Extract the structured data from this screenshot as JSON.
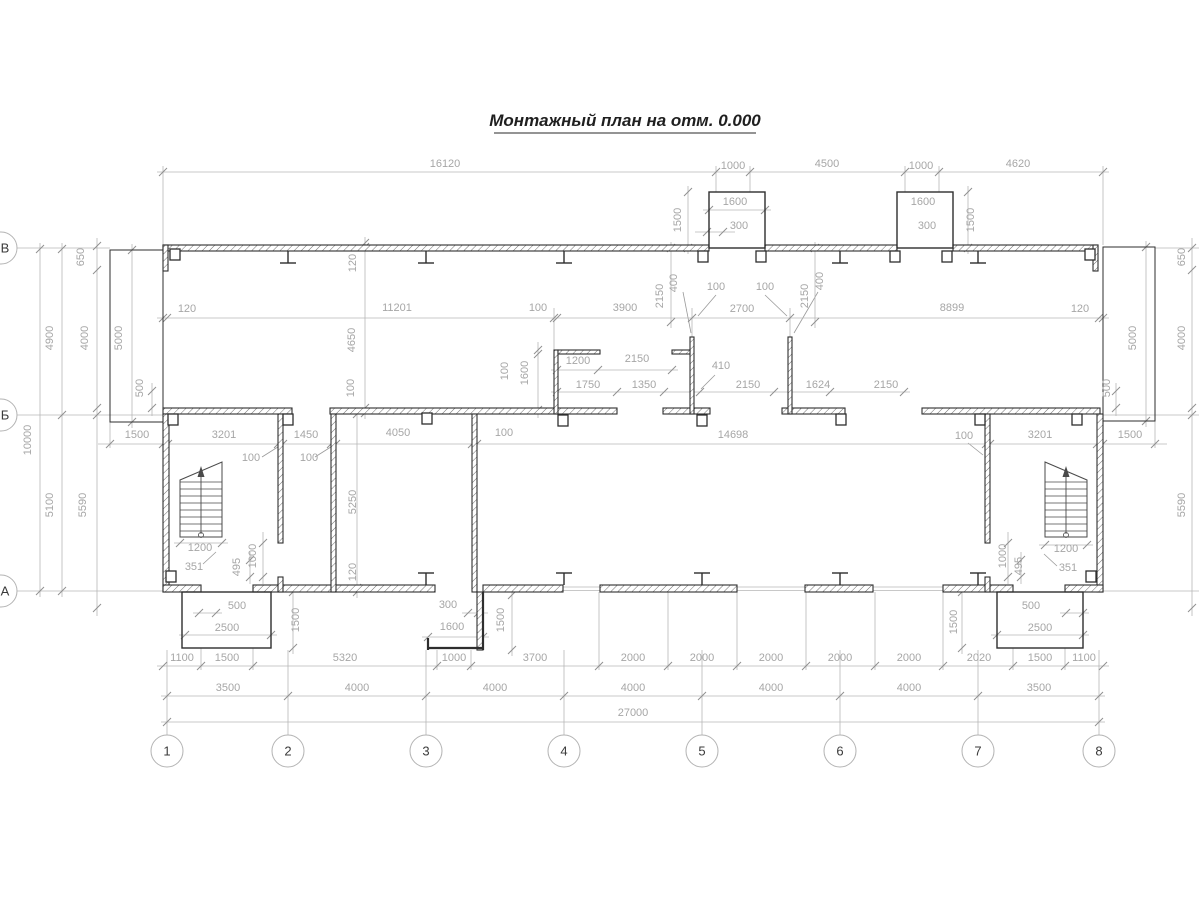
{
  "title": {
    "text": "Монтажный план на отм. 0.000"
  },
  "colors": {
    "wall_line": "#2e2e2e",
    "hatch": "#6f6f6f",
    "dim_line": "#b6b6b6",
    "dim_text": "#a6a6a6",
    "bubble_stroke": "#b3b3b3",
    "bubble_text": "#3a3a3a",
    "stair_line": "#4a4a4a"
  },
  "axes": {
    "columns": [
      {
        "label": "1",
        "x": 167
      },
      {
        "label": "2",
        "x": 288
      },
      {
        "label": "3",
        "x": 426
      },
      {
        "label": "4",
        "x": 564
      },
      {
        "label": "5",
        "x": 702
      },
      {
        "label": "6",
        "x": 840
      },
      {
        "label": "7",
        "x": 978
      },
      {
        "label": "8",
        "x": 1099
      }
    ],
    "columns_y": 751,
    "rows": [
      {
        "label": "В",
        "y": 248
      },
      {
        "label": "Б",
        "y": 415
      },
      {
        "label": "А",
        "y": 591
      }
    ],
    "rows_x": 0
  },
  "dim_labels": [
    {
      "t": "16120",
      "x": 445,
      "y": 167,
      "r": 0
    },
    {
      "t": "1000",
      "x": 733,
      "y": 169,
      "r": 0
    },
    {
      "t": "4500",
      "x": 827,
      "y": 167,
      "r": 0
    },
    {
      "t": "1000",
      "x": 921,
      "y": 169,
      "r": 0
    },
    {
      "t": "4620",
      "x": 1018,
      "y": 167,
      "r": 0
    },
    {
      "t": "1600",
      "x": 735,
      "y": 205,
      "r": 0
    },
    {
      "t": "300",
      "x": 739,
      "y": 229,
      "r": 0
    },
    {
      "t": "1500",
      "x": 681,
      "y": 220,
      "r": -90
    },
    {
      "t": "1600",
      "x": 923,
      "y": 205,
      "r": 0
    },
    {
      "t": "300",
      "x": 927,
      "y": 229,
      "r": 0
    },
    {
      "t": "1500",
      "x": 974,
      "y": 220,
      "r": -90
    },
    {
      "t": "120",
      "x": 187,
      "y": 312,
      "r": 0
    },
    {
      "t": "11201",
      "x": 397,
      "y": 311,
      "r": 0
    },
    {
      "t": "100",
      "x": 538,
      "y": 311,
      "r": 0
    },
    {
      "t": "3900",
      "x": 625,
      "y": 311,
      "r": 0
    },
    {
      "t": "100",
      "x": 716,
      "y": 290,
      "r": 0
    },
    {
      "t": "100",
      "x": 765,
      "y": 290,
      "r": 0
    },
    {
      "t": "2700",
      "x": 742,
      "y": 312,
      "r": 0
    },
    {
      "t": "8899",
      "x": 952,
      "y": 311,
      "r": 0
    },
    {
      "t": "120",
      "x": 1080,
      "y": 312,
      "r": 0
    },
    {
      "t": "2150",
      "x": 663,
      "y": 296,
      "r": -90
    },
    {
      "t": "400",
      "x": 677,
      "y": 283,
      "r": -90
    },
    {
      "t": "2150",
      "x": 808,
      "y": 296,
      "r": -90
    },
    {
      "t": "400",
      "x": 823,
      "y": 281,
      "r": -90
    },
    {
      "t": "650",
      "x": 84,
      "y": 257,
      "r": -90
    },
    {
      "t": "4900",
      "x": 53,
      "y": 338,
      "r": -90
    },
    {
      "t": "4000",
      "x": 88,
      "y": 338,
      "r": -90
    },
    {
      "t": "5000",
      "x": 122,
      "y": 338,
      "r": -90
    },
    {
      "t": "10000",
      "x": 31,
      "y": 440,
      "r": -90
    },
    {
      "t": "5100",
      "x": 53,
      "y": 505,
      "r": -90
    },
    {
      "t": "5590",
      "x": 86,
      "y": 505,
      "r": -90
    },
    {
      "t": "500",
      "x": 143,
      "y": 388,
      "r": -90
    },
    {
      "t": "1500",
      "x": 137,
      "y": 438,
      "r": 0
    },
    {
      "t": "650",
      "x": 1185,
      "y": 257,
      "r": -90
    },
    {
      "t": "4000",
      "x": 1185,
      "y": 338,
      "r": -90
    },
    {
      "t": "5000",
      "x": 1136,
      "y": 338,
      "r": -90
    },
    {
      "t": "500",
      "x": 1110,
      "y": 388,
      "r": -90
    },
    {
      "t": "5590",
      "x": 1185,
      "y": 505,
      "r": -90
    },
    {
      "t": "1500",
      "x": 1130,
      "y": 438,
      "r": 0
    },
    {
      "t": "120",
      "x": 356,
      "y": 263,
      "r": -90
    },
    {
      "t": "4650",
      "x": 355,
      "y": 340,
      "r": -90
    },
    {
      "t": "100",
      "x": 354,
      "y": 388,
      "r": -90
    },
    {
      "t": "5250",
      "x": 356,
      "y": 502,
      "r": -90
    },
    {
      "t": "120",
      "x": 356,
      "y": 572,
      "r": -90
    },
    {
      "t": "100",
      "x": 508,
      "y": 371,
      "r": -90
    },
    {
      "t": "1600",
      "x": 528,
      "y": 373,
      "r": -90
    },
    {
      "t": "1200",
      "x": 578,
      "y": 364,
      "r": 0
    },
    {
      "t": "2150",
      "x": 637,
      "y": 362,
      "r": 0
    },
    {
      "t": "410",
      "x": 721,
      "y": 369,
      "r": 0
    },
    {
      "t": "1750",
      "x": 588,
      "y": 388,
      "r": 0
    },
    {
      "t": "1350",
      "x": 644,
      "y": 388,
      "r": 0
    },
    {
      "t": "2150",
      "x": 748,
      "y": 388,
      "r": 0
    },
    {
      "t": "1624",
      "x": 818,
      "y": 388,
      "r": 0
    },
    {
      "t": "2150",
      "x": 886,
      "y": 388,
      "r": 0
    },
    {
      "t": "3201",
      "x": 224,
      "y": 438,
      "r": 0
    },
    {
      "t": "1450",
      "x": 306,
      "y": 438,
      "r": 0
    },
    {
      "t": "100",
      "x": 251,
      "y": 461,
      "r": 0
    },
    {
      "t": "100",
      "x": 309,
      "y": 461,
      "r": 0
    },
    {
      "t": "4050",
      "x": 398,
      "y": 436,
      "r": 0
    },
    {
      "t": "100",
      "x": 504,
      "y": 436,
      "r": 0
    },
    {
      "t": "14698",
      "x": 733,
      "y": 438,
      "r": 0
    },
    {
      "t": "100",
      "x": 964,
      "y": 439,
      "r": 0
    },
    {
      "t": "3201",
      "x": 1040,
      "y": 438,
      "r": 0
    },
    {
      "t": "1200",
      "x": 200,
      "y": 551,
      "r": 0
    },
    {
      "t": "351",
      "x": 194,
      "y": 570,
      "r": 0
    },
    {
      "t": "495",
      "x": 240,
      "y": 567,
      "r": -90
    },
    {
      "t": "1000",
      "x": 256,
      "y": 556,
      "r": -90
    },
    {
      "t": "1200",
      "x": 1066,
      "y": 552,
      "r": 0
    },
    {
      "t": "351",
      "x": 1068,
      "y": 571,
      "r": 0
    },
    {
      "t": "495",
      "x": 1022,
      "y": 566,
      "r": -90
    },
    {
      "t": "1000",
      "x": 1006,
      "y": 556,
      "r": -90
    },
    {
      "t": "500",
      "x": 237,
      "y": 609,
      "r": 0
    },
    {
      "t": "2500",
      "x": 227,
      "y": 631,
      "r": 0
    },
    {
      "t": "1500",
      "x": 299,
      "y": 620,
      "r": -90
    },
    {
      "t": "300",
      "x": 448,
      "y": 608,
      "r": 0
    },
    {
      "t": "1600",
      "x": 452,
      "y": 630,
      "r": 0
    },
    {
      "t": "1500",
      "x": 504,
      "y": 620,
      "r": -90
    },
    {
      "t": "500",
      "x": 1031,
      "y": 609,
      "r": 0
    },
    {
      "t": "2500",
      "x": 1040,
      "y": 631,
      "r": 0
    },
    {
      "t": "1500",
      "x": 957,
      "y": 622,
      "r": -90
    },
    {
      "t": "1100",
      "x": 182,
      "y": 661,
      "r": 0
    },
    {
      "t": "1500",
      "x": 227,
      "y": 661,
      "r": 0
    },
    {
      "t": "5320",
      "x": 345,
      "y": 661,
      "r": 0
    },
    {
      "t": "1000",
      "x": 454,
      "y": 661,
      "r": 0
    },
    {
      "t": "3700",
      "x": 535,
      "y": 661,
      "r": 0
    },
    {
      "t": "2000",
      "x": 633,
      "y": 661,
      "r": 0
    },
    {
      "t": "2000",
      "x": 702,
      "y": 661,
      "r": 0
    },
    {
      "t": "2000",
      "x": 771,
      "y": 661,
      "r": 0
    },
    {
      "t": "2000",
      "x": 840,
      "y": 661,
      "r": 0
    },
    {
      "t": "2000",
      "x": 909,
      "y": 661,
      "r": 0
    },
    {
      "t": "2020",
      "x": 979,
      "y": 661,
      "r": 0
    },
    {
      "t": "1500",
      "x": 1040,
      "y": 661,
      "r": 0
    },
    {
      "t": "1100",
      "x": 1084,
      "y": 661,
      "r": 0
    },
    {
      "t": "3500",
      "x": 228,
      "y": 691,
      "r": 0
    },
    {
      "t": "4000",
      "x": 357,
      "y": 691,
      "r": 0
    },
    {
      "t": "4000",
      "x": 495,
      "y": 691,
      "r": 0
    },
    {
      "t": "4000",
      "x": 633,
      "y": 691,
      "r": 0
    },
    {
      "t": "4000",
      "x": 771,
      "y": 691,
      "r": 0
    },
    {
      "t": "4000",
      "x": 909,
      "y": 691,
      "r": 0
    },
    {
      "t": "3500",
      "x": 1039,
      "y": 691,
      "r": 0
    },
    {
      "t": "27000",
      "x": 633,
      "y": 716,
      "r": 0
    }
  ]
}
